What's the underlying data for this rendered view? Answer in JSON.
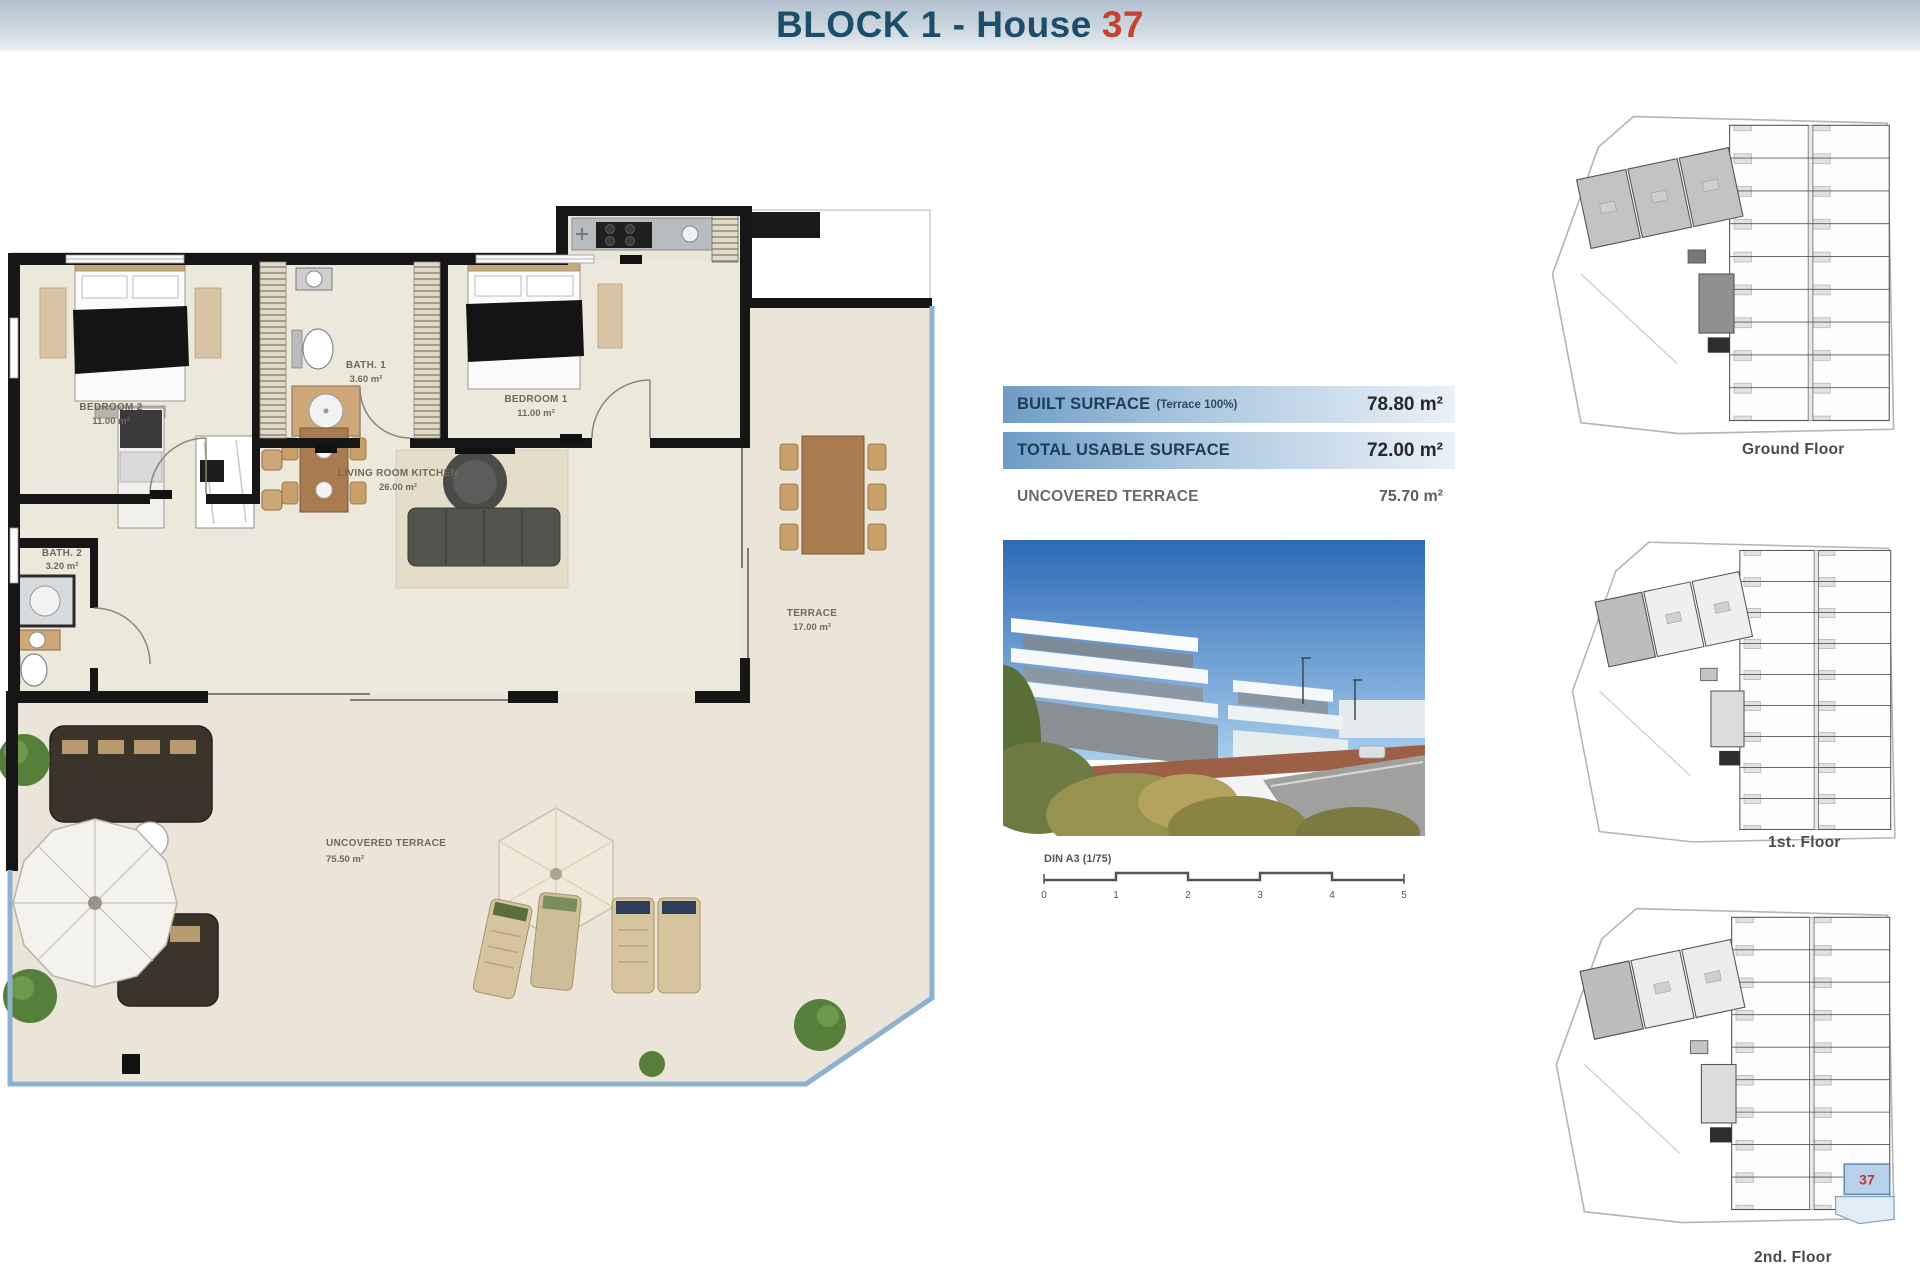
{
  "header": {
    "title_main": "BLOCK 1 - House",
    "title_number": "37"
  },
  "floor_plan": {
    "rooms": {
      "bedroom2": {
        "name": "BEDROOM 2",
        "area": "11.00 m²"
      },
      "bath1": {
        "name": "BATH. 1",
        "area": "3.60 m²"
      },
      "bedroom1": {
        "name": "BEDROOM 1",
        "area": "11.00 m²"
      },
      "living": {
        "name": "LIVING ROOM KITCHEN",
        "area": "26.00 m²"
      },
      "bath2": {
        "name": "BATH. 2",
        "area": "3.20 m²"
      },
      "terrace": {
        "name": "TERRACE",
        "area": "17.00 m²"
      },
      "uncovered": {
        "name": "UNCOVERED TERRACE",
        "area": "75.50 m²"
      }
    }
  },
  "surface_table": {
    "built": {
      "label": "BUILT SURFACE",
      "note": "(Terrace 100%)",
      "value": "78.80 m²"
    },
    "usable": {
      "label": "TOTAL USABLE SURFACE",
      "value": "72.00 m²"
    },
    "uncovered": {
      "label": "UNCOVERED TERRACE",
      "value": "75.70 m²"
    }
  },
  "scale_bar": {
    "label": "DIN A3 (1/75)",
    "ticks": [
      "0",
      "1",
      "2",
      "3",
      "4",
      "5"
    ]
  },
  "site_plans": {
    "ground": {
      "label": "Ground Floor"
    },
    "first": {
      "label": "1st. Floor"
    },
    "second": {
      "label": "2nd. Floor",
      "highlighted_unit": "37"
    }
  },
  "colors": {
    "title_text": "#1c4e6b",
    "title_accent": "#c2432f",
    "table_row_blue": "#6e9cc7",
    "plan_floor_beige": "#eae5d8",
    "wall_black": "#161616",
    "balustrade_blue": "#8db1d0",
    "unit_highlight_fill": "#b8d2ec",
    "unit_highlight_number": "#c0392b"
  }
}
